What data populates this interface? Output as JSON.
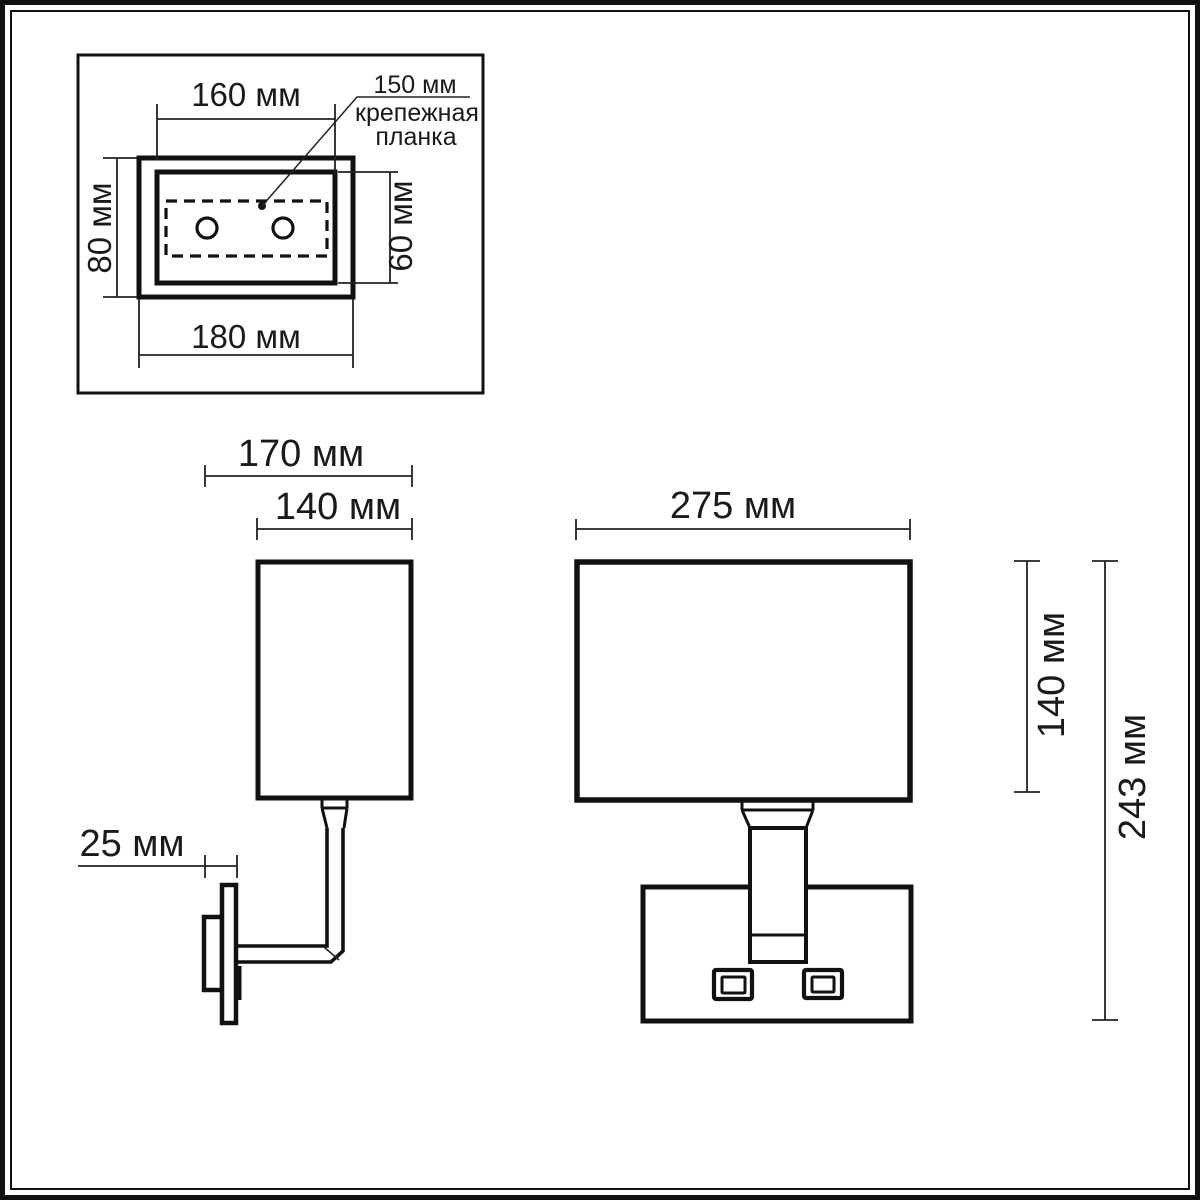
{
  "drawing": {
    "type": "wall-lamp-dimension-drawing",
    "colors": {
      "background": "#ffffff",
      "line": "#111111",
      "dim_line": "#222222",
      "text": "#1a1a1a"
    }
  },
  "detail_inset": {
    "dim_top": "160 мм",
    "dim_bottom": "180 мм",
    "dim_left": "80 мм",
    "dim_right": "60 мм",
    "callout_value": "150 мм",
    "callout_line1": "крепежная",
    "callout_line2": "планка"
  },
  "side_view": {
    "dim_total_depth": "170 мм",
    "dim_shade_depth": "140 мм",
    "dim_plate_depth": "25 мм"
  },
  "front_view": {
    "dim_shade_width": "275 мм",
    "dim_shade_height": "140 мм",
    "dim_total_height": "243 мм"
  }
}
